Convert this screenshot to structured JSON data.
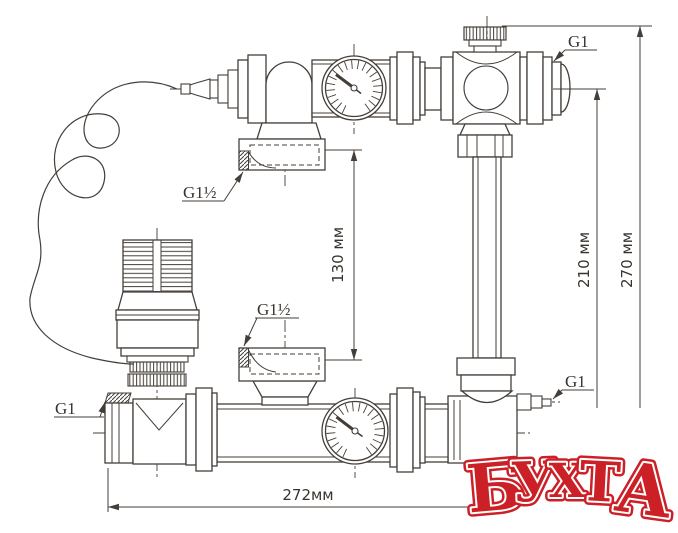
{
  "labels": {
    "g1_half_top": "G1½",
    "g1_half_bottom": "G1½",
    "g1_top_right": "G1",
    "g1_bottom_right": "G1",
    "g1_bottom_left": "G1"
  },
  "dimensions": {
    "port_spacing": "130 мм",
    "center_height": "210 мм",
    "overall_height": "270 мм",
    "overall_width": "272мм"
  },
  "logo": {
    "text": "БУХТА",
    "letters": [
      "Б",
      "У",
      "Х",
      "Т",
      "А"
    ],
    "color": "#cc2027"
  },
  "colors": {
    "line": "#443e39",
    "text": "#38332e",
    "background": "#ffffff"
  }
}
